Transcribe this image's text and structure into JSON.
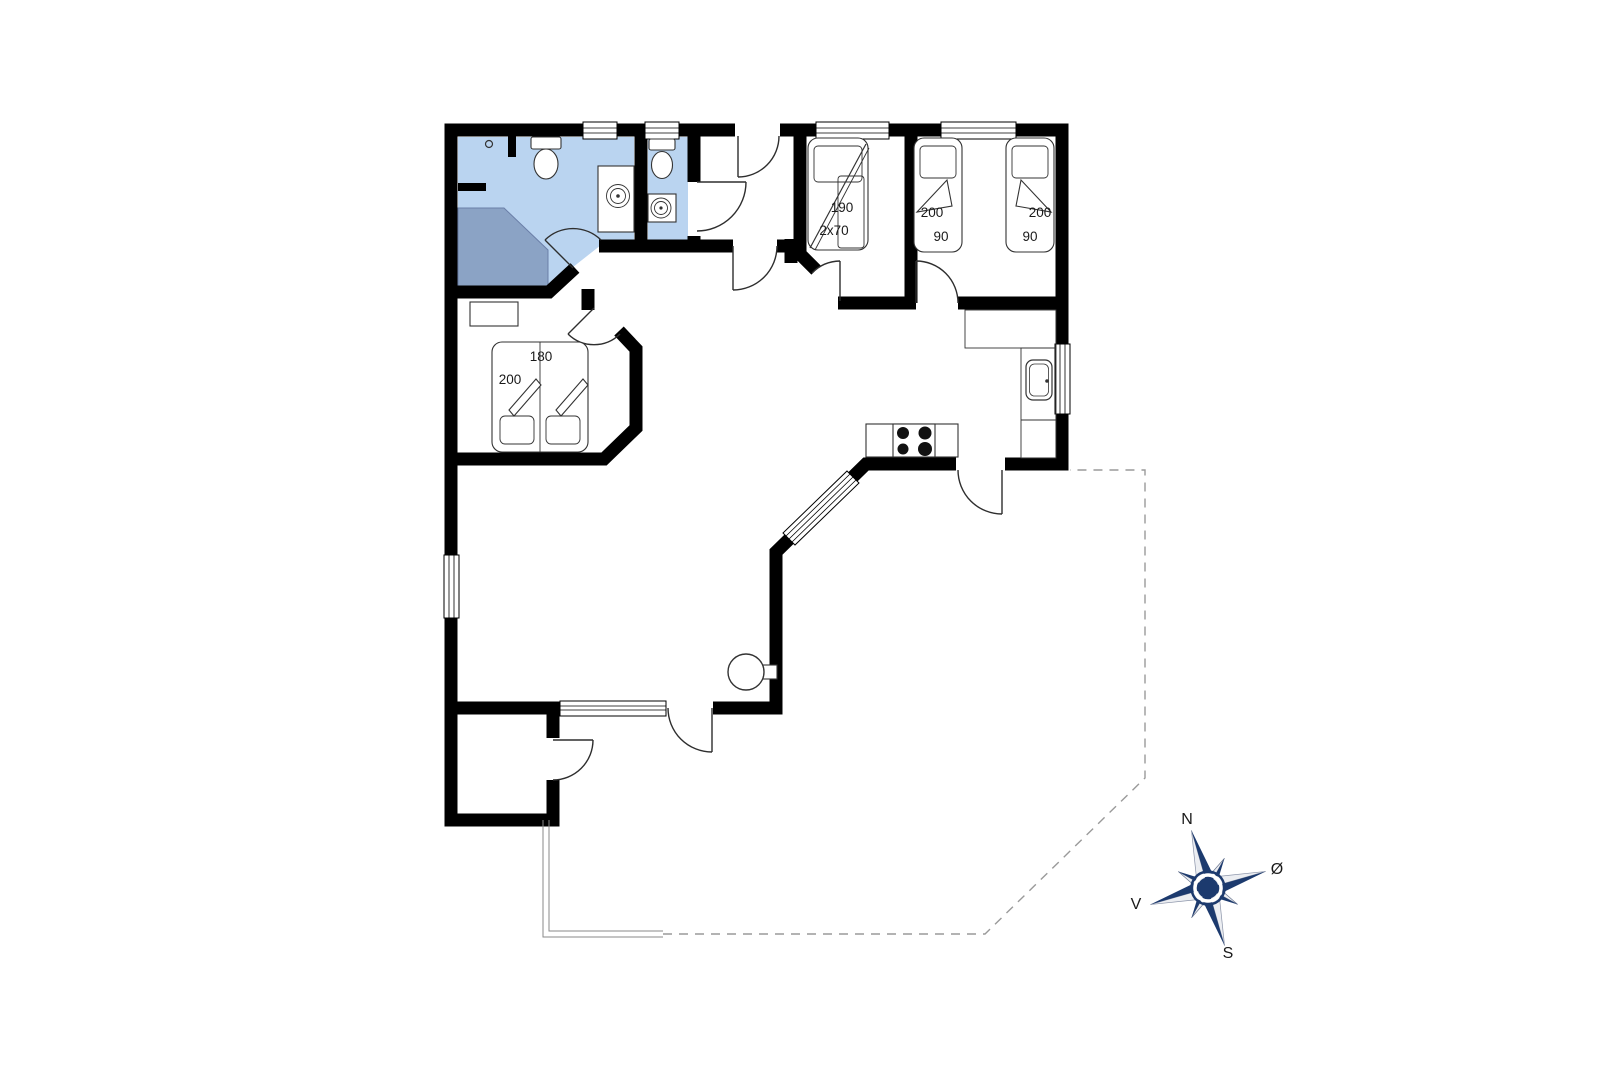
{
  "plan": {
    "beds": {
      "bunk": {
        "length": "190",
        "size": "2x70"
      },
      "single_left": {
        "length": "200",
        "width": "90"
      },
      "single_right": {
        "length": "200",
        "width": "90"
      },
      "double": {
        "width": "180",
        "length": "200"
      }
    },
    "compass": {
      "north": "N",
      "east": "Ø",
      "south": "S",
      "west": "V"
    },
    "colors": {
      "wall": "#000000",
      "bathroom_floor": "#bad4f0",
      "shower": "#8ba3c5",
      "compass_navy": "#1c3a6e",
      "compass_light": "#eceef2",
      "terrace_dash": "#9a9a9a",
      "label": "#1a1a1a"
    }
  }
}
